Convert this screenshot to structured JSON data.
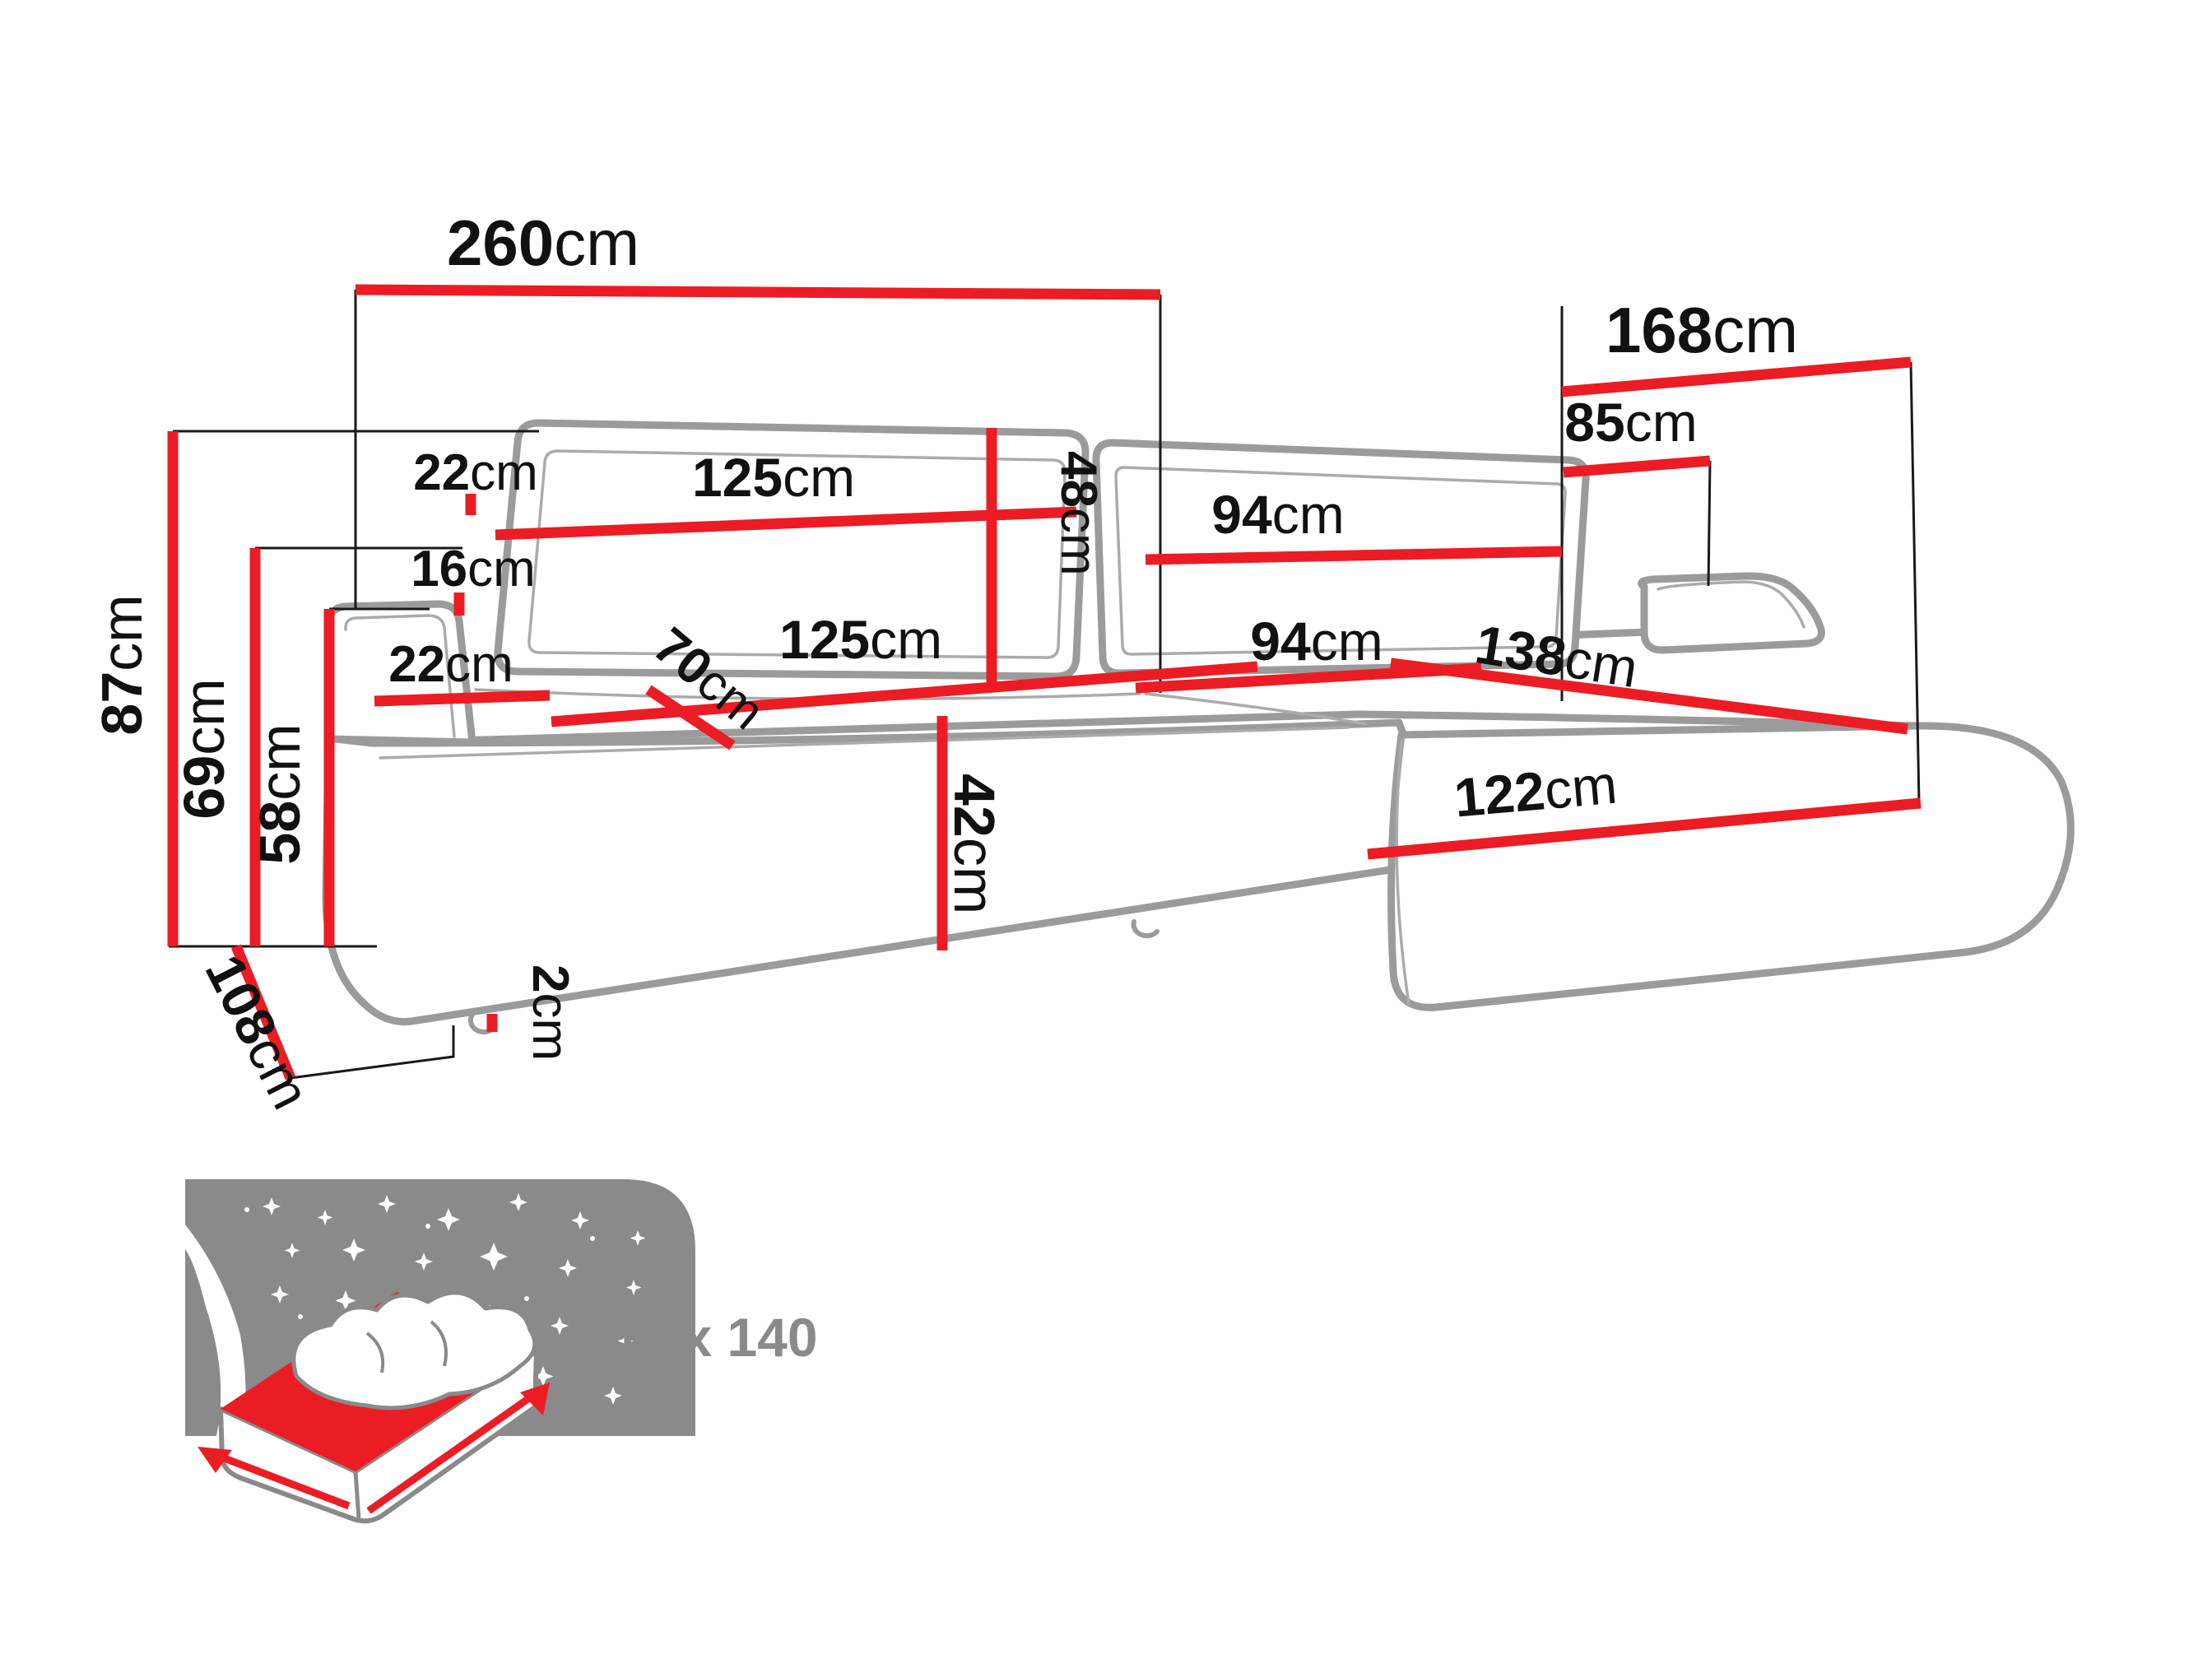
{
  "diagram_title": "corner-sofa-dimension-diagram",
  "colors": {
    "dimension_red": "#EC1C24",
    "outline_gray": "#9B9B9B",
    "label_black": "#111111",
    "icon_gray": "#8A8A8A"
  },
  "dimensions": {
    "total_width": {
      "num": "260",
      "unit": "cm"
    },
    "total_depth": {
      "num": "168",
      "unit": "cm"
    },
    "right_section_width": {
      "num": "85",
      "unit": "cm"
    },
    "overall_height": {
      "num": "87",
      "unit": "cm"
    },
    "back_height": {
      "num": "69",
      "unit": "cm"
    },
    "armrest_height": {
      "num": "58",
      "unit": "cm"
    },
    "backrest_offset_top": {
      "num": "22",
      "unit": "cm"
    },
    "backrest_offset_bottom": {
      "num": "16",
      "unit": "cm"
    },
    "backrest_cushion_left_width": {
      "num": "125",
      "unit": "cm"
    },
    "backrest_cushion_height": {
      "num": "48",
      "unit": "cm"
    },
    "backrest_cushion_right_width": {
      "num": "94",
      "unit": "cm"
    },
    "armrest_width": {
      "num": "22",
      "unit": "cm"
    },
    "seat_depth": {
      "num": "70",
      "unit": "cm"
    },
    "seat_left_width": {
      "num": "125",
      "unit": "cm"
    },
    "seat_right_width": {
      "num": "94",
      "unit": "cm"
    },
    "chaise_length": {
      "num": "138",
      "unit": "cm"
    },
    "chaise_front_width": {
      "num": "122",
      "unit": "cm"
    },
    "base_depth": {
      "num": "108",
      "unit": "cm"
    },
    "leg_height": {
      "num": "2",
      "unit": "cm"
    }
  },
  "sleeping_area": {
    "label": "240 x 140"
  }
}
